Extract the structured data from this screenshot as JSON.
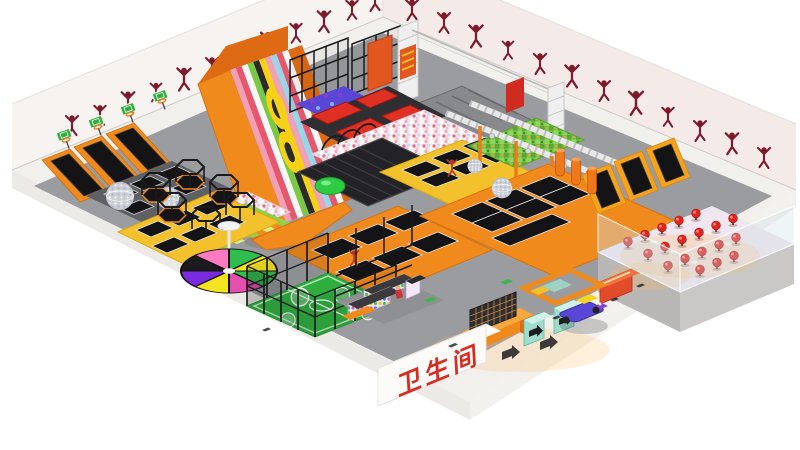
{
  "title": "indoor-trampoline-park-3d-render",
  "sign": {
    "restroom": "卫生间"
  },
  "zones": [
    "wall-silhouette-mural",
    "basketball-dunk-lanes",
    "hexagon-climb-frames",
    "mirror-ball-trampolines",
    "rainbow-donut-slide",
    "ball-pit",
    "green-lane-ball-pit",
    "inflatable-air-track",
    "zipline",
    "tumbling-mats",
    "climbing-lattice",
    "ninja-obstacle-course",
    "foam-pit",
    "free-jump-trampoline-courts",
    "angled-wall-trampolines",
    "punching-bags",
    "pinwheel-trampoline",
    "bubble-soccer-court",
    "retail-and-arcade",
    "shoe-lockers",
    "entrance-turnstiles",
    "kiddie-rides",
    "cafe-lounge",
    "restroom"
  ],
  "counts": {
    "wall_silhouettes": 24,
    "cafe_chairs": 19,
    "dunk_lanes": 3,
    "wall_trampoline_wedges": 3
  },
  "colors": {
    "bg": "#FFFFFF",
    "wallWhite": "#F6F3F0",
    "wallPink": "#F4EAE8",
    "slabWhite": "#F1F0ED",
    "floorGray": "#9B9CA0",
    "orange": "#F08A1D",
    "orangeDeep": "#DE6A14",
    "yellowPad": "#F3C12B",
    "frameBlack": "#1B1B1E",
    "matBlack": "#141416",
    "maroon": "#7C1B2C",
    "red": "#E03024",
    "chairRed": "#E0251F",
    "signRed": "#D82C20",
    "turfGreen": "#2FAE3E",
    "limeGreen": "#8FD14F",
    "teal": "#9FDCCB",
    "blue": "#5A46D6",
    "purple": "#8A3FD0",
    "magenta": "#E44FB0",
    "trussWhite": "#EFEFEF",
    "glow": "#FFB95A"
  }
}
